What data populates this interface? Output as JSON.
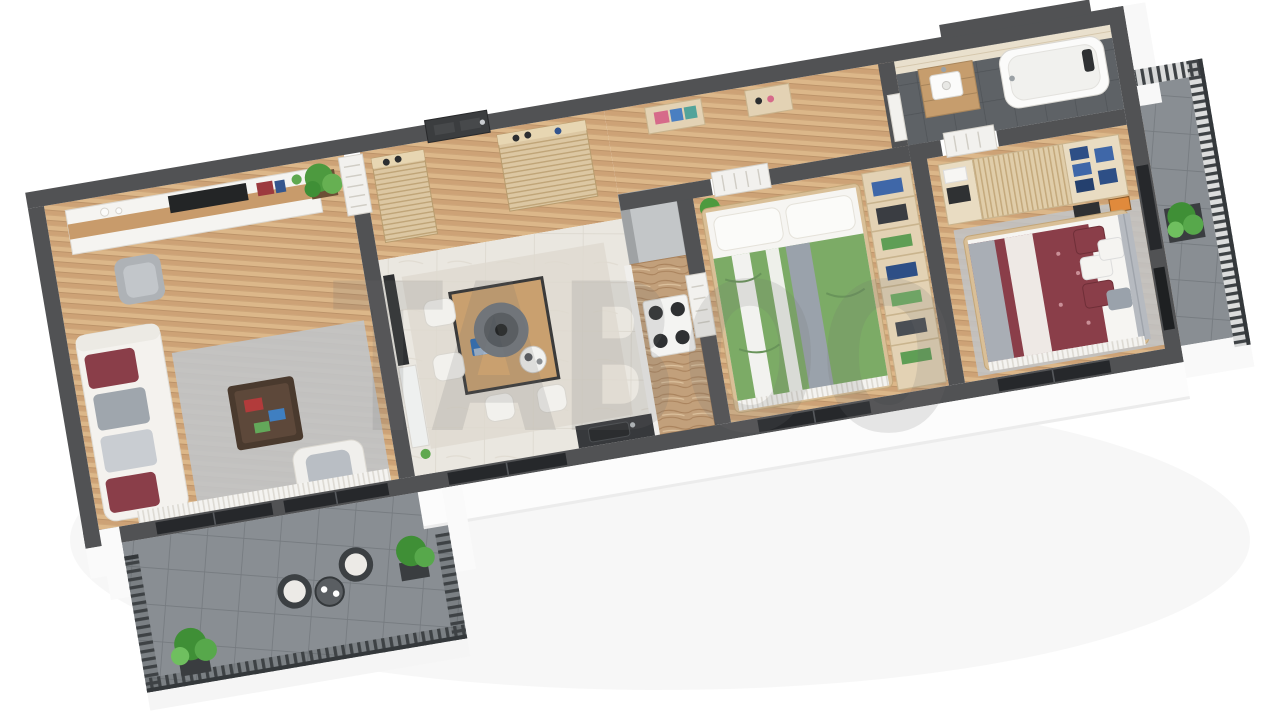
{
  "meta": {
    "title": "3D cutaway floor plan rendering of a 3-room apartment",
    "view": "isometric top-down cutaway, white background"
  },
  "watermark": {
    "text": "TABOO",
    "color": "#6e6e6e"
  },
  "palette": {
    "background": "#ffffff",
    "wall": "#515254",
    "wall_dark": "#3b3d3f",
    "wood_floor": "#d5b083",
    "tile_floor": "#eae7e0",
    "bathroom_floor": "#5e6266",
    "terrace_floor": "#898e93",
    "travertine_wall": "#e9e0cd",
    "marble_counter": "#c2a07b",
    "sofa": "#f4f2ee",
    "rug": "#c1c4c8",
    "bed_green": "#7cab66",
    "bed_maroon": "#8a3e49",
    "wood_furniture": "#c89b6b",
    "closet_wood": "#e3d2b4",
    "railing": "#3e4245",
    "door_white": "#f2f1ee",
    "window_glass": "#26282b",
    "plant_green": "#4d9a3f"
  },
  "rooms": [
    {
      "name": "Living room",
      "floor": "oak plank flooring",
      "items": [
        "white fabric sofa with maroon and gray cushions",
        "gray rug",
        "dark walnut coffee table with books",
        "white lounge chair",
        "gray armchair",
        "wall shelving unit with TV and decor",
        "potted palm plant",
        "sheer curtains",
        "glass balcony doors"
      ]
    },
    {
      "name": "Entry hall",
      "floor": "oak plank flooring",
      "items": [
        "dark gray entrance door",
        "louvered shoe cabinet with shoes on top",
        "louvered wardrobe with shoes on top"
      ]
    },
    {
      "name": "Kitchen and dining room",
      "floor": "light stone tile",
      "items": [
        "wood dining table with open laptop and serving tray",
        "four white chairs",
        "gray cone pendant lamp",
        "TV panel with white marble sideboard",
        "tall gray fridge cabinet",
        "marble kitchen counter",
        "four-burner gas hob",
        "dark sink counter under window"
      ]
    },
    {
      "name": "Corridor",
      "floor": "oak plank flooring",
      "items": [
        "white paneled interior doors",
        "storage niche with folded towels",
        "storage niche with shoes"
      ]
    },
    {
      "name": "Bedroom 1",
      "floor": "oak plank flooring",
      "items": [
        "double bed with green and white striped duvet and gray throw",
        "two white pillows",
        "potted plant",
        "walk-in closet shelving with blue clothes, green towels and boxes"
      ]
    },
    {
      "name": "Bedroom 2",
      "floor": "oak plank flooring with gray rug",
      "items": [
        "double bed with maroon patterned duvet and white throw",
        "gray upholstered headboard",
        "maroon, white and gray pillows",
        "slatted wardrobe with open shelves of folded jeans and white linens",
        "black nightstand",
        "orange artwork",
        "wall-mounted TV"
      ]
    },
    {
      "name": "Bathroom",
      "floor": "dark gray tile",
      "items": [
        "white bathtub with dark headrest and chrome faucet",
        "wood vanity cabinet with white washbasin",
        "travertine walls"
      ]
    },
    {
      "name": "Terrace",
      "floor": "gray stone tile",
      "items": [
        "dark metal baluster railing",
        "two rattan chairs with white seat cushions",
        "round bistro table with two cups",
        "two green potted plants"
      ]
    },
    {
      "name": "Side balcony",
      "floor": "gray stone tile",
      "items": [
        "dark slatted railing",
        "green shrub in dark planter"
      ]
    }
  ]
}
